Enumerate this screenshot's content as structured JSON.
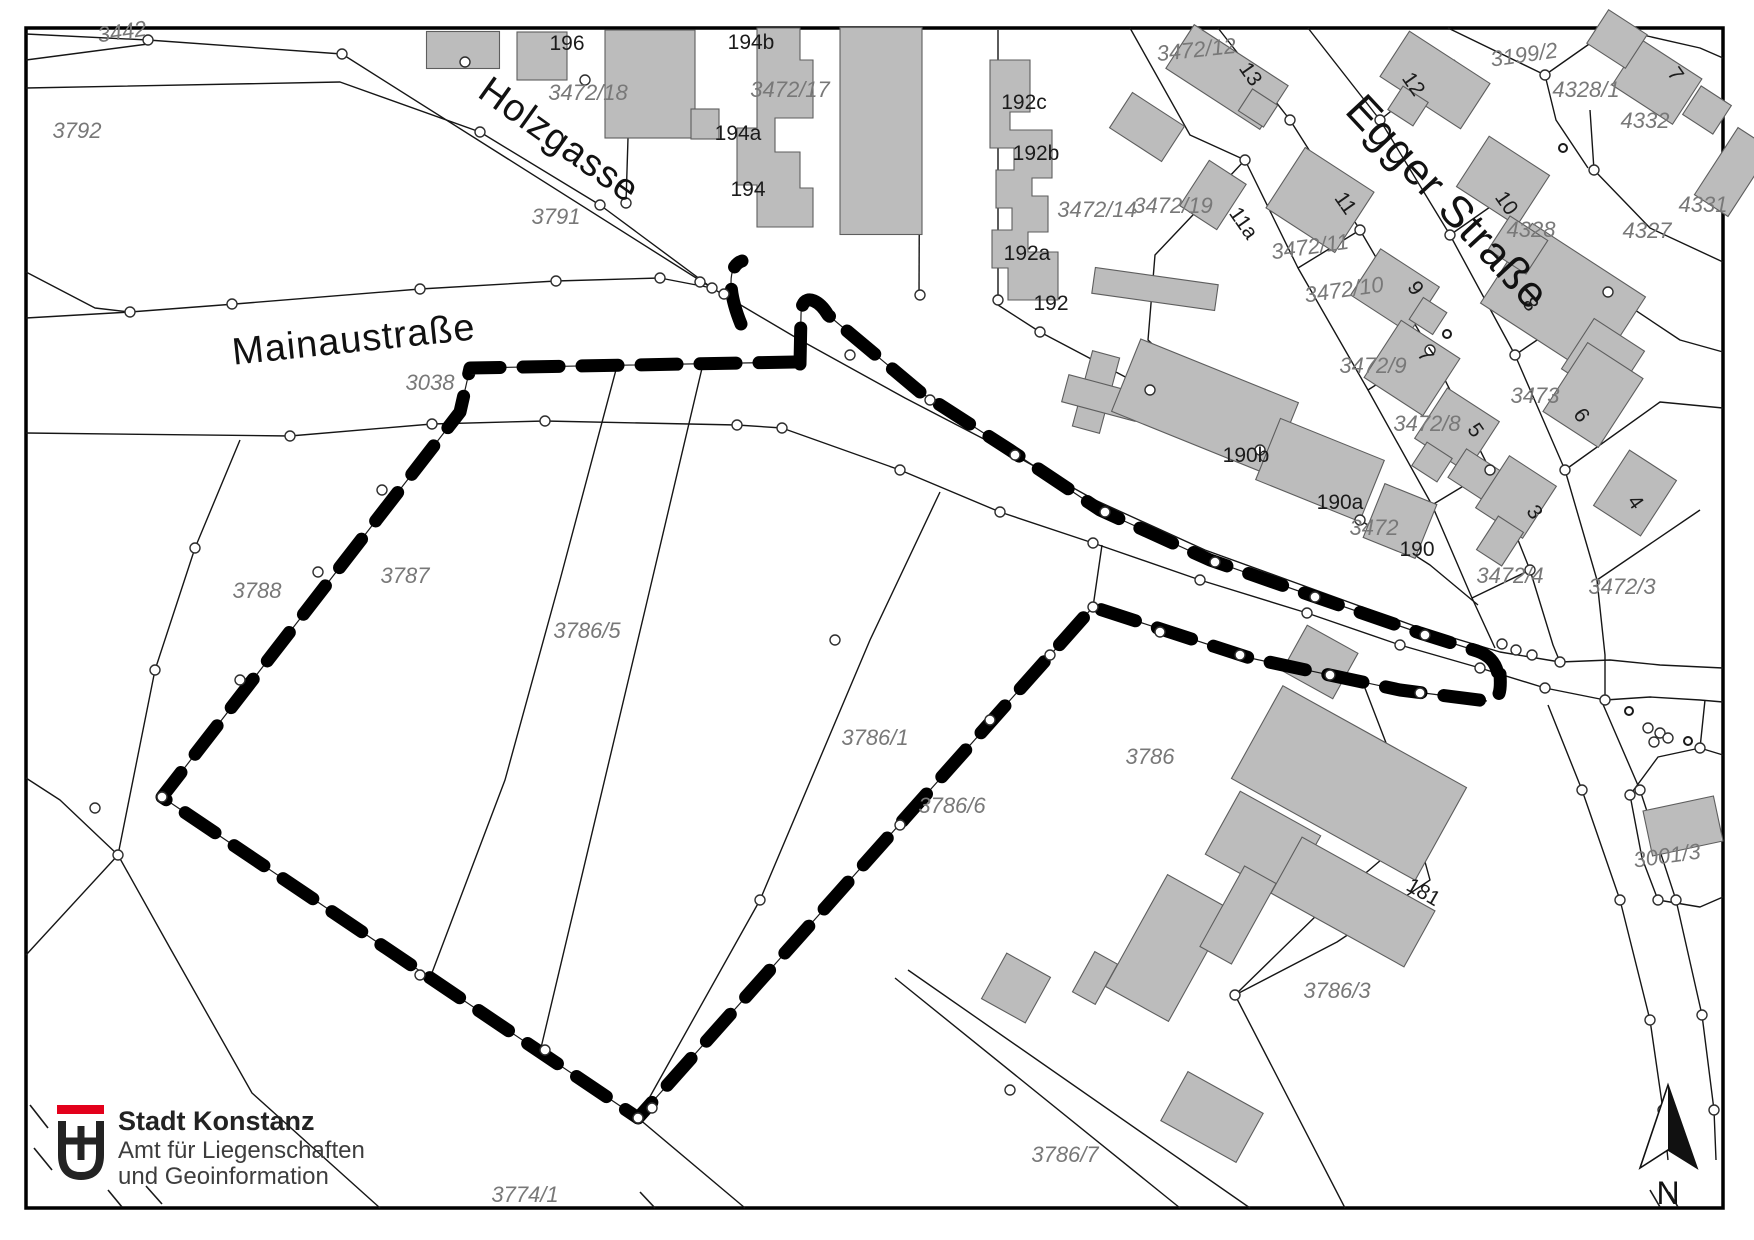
{
  "colors": {
    "background": "#ffffff",
    "building_fill": "#bcbcbc",
    "building_stroke": "#5e5e5e",
    "parcel_line": "#161616",
    "parcel_label": "#787878",
    "house_label": "#1b1b1b",
    "selection": "#000000",
    "logo_red": "#e3001b"
  },
  "streets": [
    {
      "name": "Holzgasse",
      "x": 552,
      "y": 150,
      "rot": 35.5,
      "big": false
    },
    {
      "name": "Mainaustraße",
      "x": 355,
      "y": 352,
      "rot": -6,
      "big": false
    },
    {
      "name": "Egger Straße",
      "x": 1437,
      "y": 212,
      "rot": 47,
      "big": true
    }
  ],
  "parcel_labels": [
    {
      "text": "3442",
      "x": 123,
      "y": 39,
      "rot": -8
    },
    {
      "text": "3792",
      "x": 77,
      "y": 138,
      "rot": 0
    },
    {
      "text": "3472/18",
      "x": 588,
      "y": 100,
      "rot": 0
    },
    {
      "text": "3472/17",
      "x": 790,
      "y": 97,
      "rot": 0
    },
    {
      "text": "3791",
      "x": 556,
      "y": 224,
      "rot": 0
    },
    {
      "text": "3038",
      "x": 430,
      "y": 390,
      "rot": 0
    },
    {
      "text": "3472/14",
      "x": 1097,
      "y": 217,
      "rot": 0
    },
    {
      "text": "3472/19",
      "x": 1173,
      "y": 213,
      "rot": 0
    },
    {
      "text": "3472/12",
      "x": 1197,
      "y": 57,
      "rot": -6
    },
    {
      "text": "3199/2",
      "x": 1525,
      "y": 62,
      "rot": -8
    },
    {
      "text": "4328/1",
      "x": 1586,
      "y": 97,
      "rot": 0
    },
    {
      "text": "4332",
      "x": 1645,
      "y": 128,
      "rot": 0
    },
    {
      "text": "4331",
      "x": 1703,
      "y": 212,
      "rot": 0
    },
    {
      "text": "4327",
      "x": 1647,
      "y": 238,
      "rot": 0
    },
    {
      "text": "4328",
      "x": 1531,
      "y": 237,
      "rot": 0
    },
    {
      "text": "3472/11",
      "x": 1311,
      "y": 254,
      "rot": -8
    },
    {
      "text": "3472/10",
      "x": 1345,
      "y": 297,
      "rot": -8
    },
    {
      "text": "3472/9",
      "x": 1373,
      "y": 373,
      "rot": 0
    },
    {
      "text": "3473",
      "x": 1535,
      "y": 403,
      "rot": 0
    },
    {
      "text": "3472/8",
      "x": 1427,
      "y": 431,
      "rot": 0
    },
    {
      "text": "3472",
      "x": 1374,
      "y": 535,
      "rot": 0
    },
    {
      "text": "3472/4",
      "x": 1510,
      "y": 583,
      "rot": 0
    },
    {
      "text": "3472/3",
      "x": 1622,
      "y": 594,
      "rot": 0
    },
    {
      "text": "3788",
      "x": 257,
      "y": 598,
      "rot": 0
    },
    {
      "text": "3787",
      "x": 405,
      "y": 583,
      "rot": 0
    },
    {
      "text": "3786/5",
      "x": 587,
      "y": 638,
      "rot": 0
    },
    {
      "text": "3786/1",
      "x": 875,
      "y": 745,
      "rot": 0
    },
    {
      "text": "3786/6",
      "x": 952,
      "y": 813,
      "rot": 0
    },
    {
      "text": "3786",
      "x": 1150,
      "y": 764,
      "rot": 0
    },
    {
      "text": "3786/7",
      "x": 1065,
      "y": 1162,
      "rot": 0
    },
    {
      "text": "3786/3",
      "x": 1337,
      "y": 998,
      "rot": 0
    },
    {
      "text": "3774/1",
      "x": 525,
      "y": 1202,
      "rot": 0
    },
    {
      "text": "3001/3",
      "x": 1668,
      "y": 863,
      "rot": -8
    }
  ],
  "house_numbers": [
    {
      "text": "196",
      "x": 567,
      "y": 50,
      "rot": 0
    },
    {
      "text": "194b",
      "x": 751,
      "y": 49,
      "rot": 0
    },
    {
      "text": "194a",
      "x": 738,
      "y": 140,
      "rot": 0
    },
    {
      "text": "194",
      "x": 748,
      "y": 196,
      "rot": 0
    },
    {
      "text": "192c",
      "x": 1024,
      "y": 109,
      "rot": 0
    },
    {
      "text": "192b",
      "x": 1036,
      "y": 160,
      "rot": 0
    },
    {
      "text": "192a",
      "x": 1027,
      "y": 260,
      "rot": 0
    },
    {
      "text": "192",
      "x": 1051,
      "y": 310,
      "rot": 0
    },
    {
      "text": "190b",
      "x": 1246,
      "y": 462,
      "rot": 0
    },
    {
      "text": "190a",
      "x": 1340,
      "y": 509,
      "rot": 0
    },
    {
      "text": "190",
      "x": 1417,
      "y": 556,
      "rot": 0
    },
    {
      "text": "181",
      "x": 1420,
      "y": 898,
      "rot": 30
    },
    {
      "text": "13",
      "x": 1245,
      "y": 78,
      "rot": 55
    },
    {
      "text": "12",
      "x": 1408,
      "y": 88,
      "rot": 55
    },
    {
      "text": "11a",
      "x": 1238,
      "y": 227,
      "rot": 55
    },
    {
      "text": "11",
      "x": 1340,
      "y": 207,
      "rot": 55
    },
    {
      "text": "10",
      "x": 1501,
      "y": 207,
      "rot": 55
    },
    {
      "text": "9",
      "x": 1410,
      "y": 292,
      "rot": 55
    },
    {
      "text": "7",
      "x": 1670,
      "y": 78,
      "rot": 55
    },
    {
      "text": "8",
      "x": 1525,
      "y": 308,
      "rot": 55
    },
    {
      "text": "7",
      "x": 1420,
      "y": 359,
      "rot": 55
    },
    {
      "text": "6",
      "x": 1576,
      "y": 419,
      "rot": 55
    },
    {
      "text": "5",
      "x": 1470,
      "y": 434,
      "rot": 55
    },
    {
      "text": "4",
      "x": 1630,
      "y": 506,
      "rot": 55
    },
    {
      "text": "3",
      "x": 1529,
      "y": 516,
      "rot": 55
    }
  ],
  "logo": {
    "title": "Stadt Konstanz",
    "subtitle1": "Amt für Liegenschaften",
    "subtitle2": "und Geoinformation"
  },
  "north_arrow": {
    "label": "N"
  }
}
